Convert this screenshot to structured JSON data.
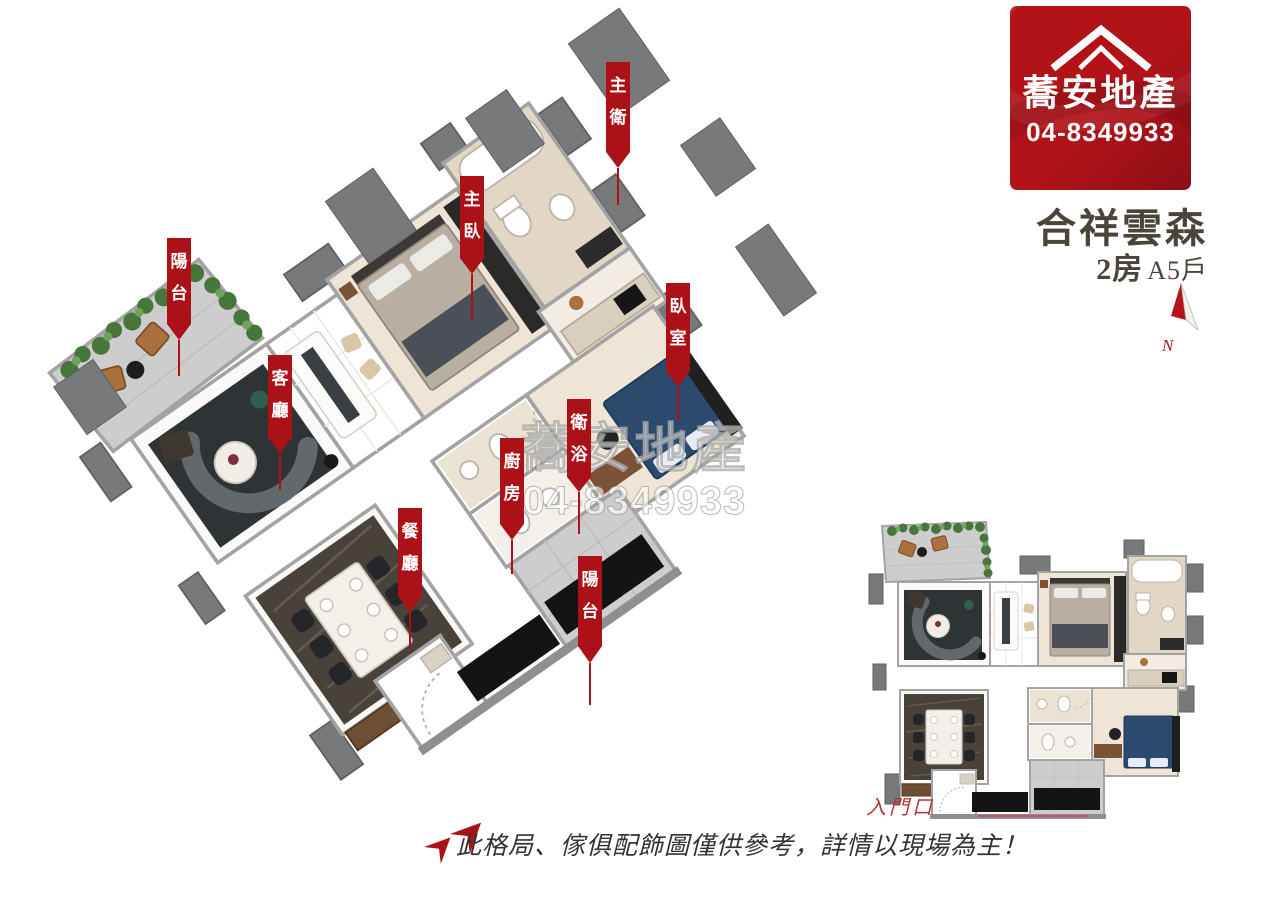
{
  "brand_card": {
    "name": "蕎安地產",
    "phone": "04-8349933",
    "icon": "roof-icon"
  },
  "project": {
    "title": "合祥雲森",
    "rooms": "2房",
    "unit": "A5戶"
  },
  "compass": {
    "label": "N"
  },
  "watermark": {
    "line1": "蕎安地產",
    "line2": "04-8349933"
  },
  "room_labels": [
    {
      "id": "zhu-wei",
      "text": "主衛",
      "x": 606,
      "y": 62,
      "body_h": 90,
      "tip_h": 16,
      "line_len": 37
    },
    {
      "id": "zhu-wo",
      "text": "主臥",
      "x": 460,
      "y": 176,
      "body_h": 82,
      "tip_h": 16,
      "line_len": 46
    },
    {
      "id": "yang-tai-1",
      "text": "陽台",
      "x": 167,
      "y": 238,
      "body_h": 86,
      "tip_h": 16,
      "line_len": 36
    },
    {
      "id": "ke-ting",
      "text": "客廳",
      "x": 268,
      "y": 355,
      "body_h": 82,
      "tip_h": 16,
      "line_len": 37
    },
    {
      "id": "wo-shi",
      "text": "臥室",
      "x": 666,
      "y": 283,
      "body_h": 88,
      "tip_h": 16,
      "line_len": 34
    },
    {
      "id": "wei-yu",
      "text": "衛浴",
      "x": 567,
      "y": 399,
      "body_h": 78,
      "tip_h": 15,
      "line_len": 42
    },
    {
      "id": "chu-fang",
      "text": "廚房",
      "x": 500,
      "y": 438,
      "body_h": 86,
      "tip_h": 16,
      "line_len": 34
    },
    {
      "id": "can-ting",
      "text": "餐廳",
      "x": 398,
      "y": 508,
      "body_h": 88,
      "tip_h": 16,
      "line_len": 38
    },
    {
      "id": "yang-tai-2",
      "text": "陽台",
      "x": 578,
      "y": 556,
      "body_h": 90,
      "tip_h": 17,
      "line_len": 42
    }
  ],
  "mini_plan": {
    "entrance_label": "入門口"
  },
  "disclaimer": "此格局、傢俱配飾圖僅供參考，詳情以現場為主！",
  "colors": {
    "label_red": "#ad1118",
    "logo_red": "#b11319",
    "logo_red_dark": "#8c0e15",
    "title_text": "#4b443a",
    "disclaimer_text": "#333333",
    "entrance_red": "#b23537",
    "compass_red": "#b5121c"
  }
}
